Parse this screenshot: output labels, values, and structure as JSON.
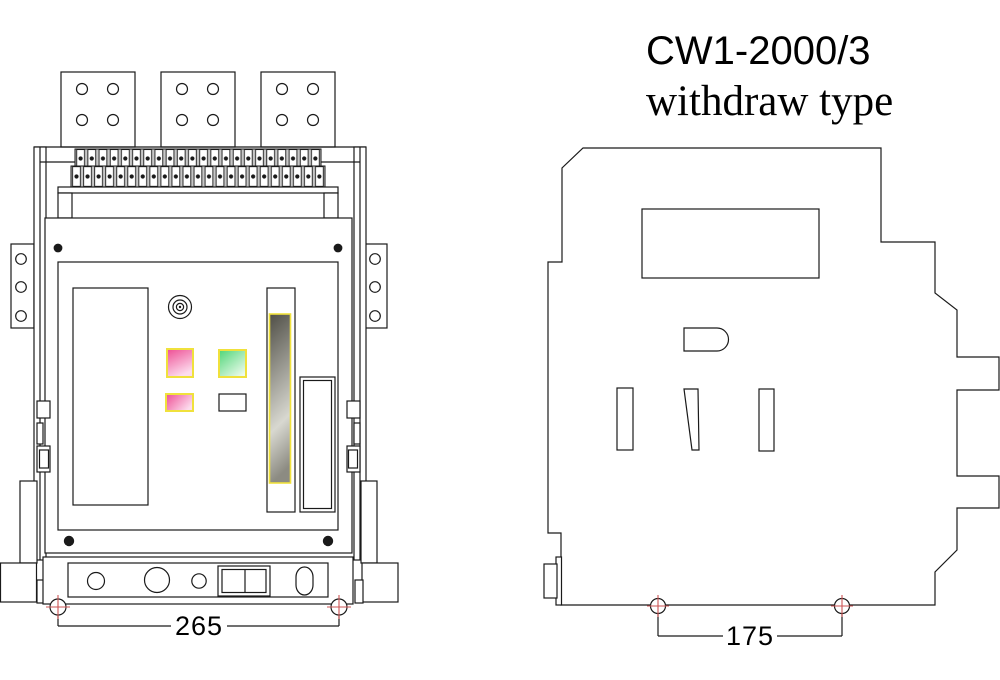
{
  "title": {
    "line1": "CW1-2000/3",
    "line2": "withdraw type"
  },
  "front_view": {
    "dimension_label": "265"
  },
  "side_view": {
    "dimension_label": "175"
  },
  "colors": {
    "line": "#1a1a1a",
    "indicator_yellow_border": "#f0e13c",
    "indicator_pink_dark": "#ee4d93",
    "indicator_pink_light": "#fcdcee",
    "indicator_green_dark": "#4fd578",
    "indicator_green_light": "#ecfbec",
    "slot_dark": "#4f4e46",
    "slot_light": "#d8d8d0",
    "slot_end": "#8c8b82",
    "marker_red": "#cc5555",
    "terminal_gray": "#c7c7c7"
  }
}
